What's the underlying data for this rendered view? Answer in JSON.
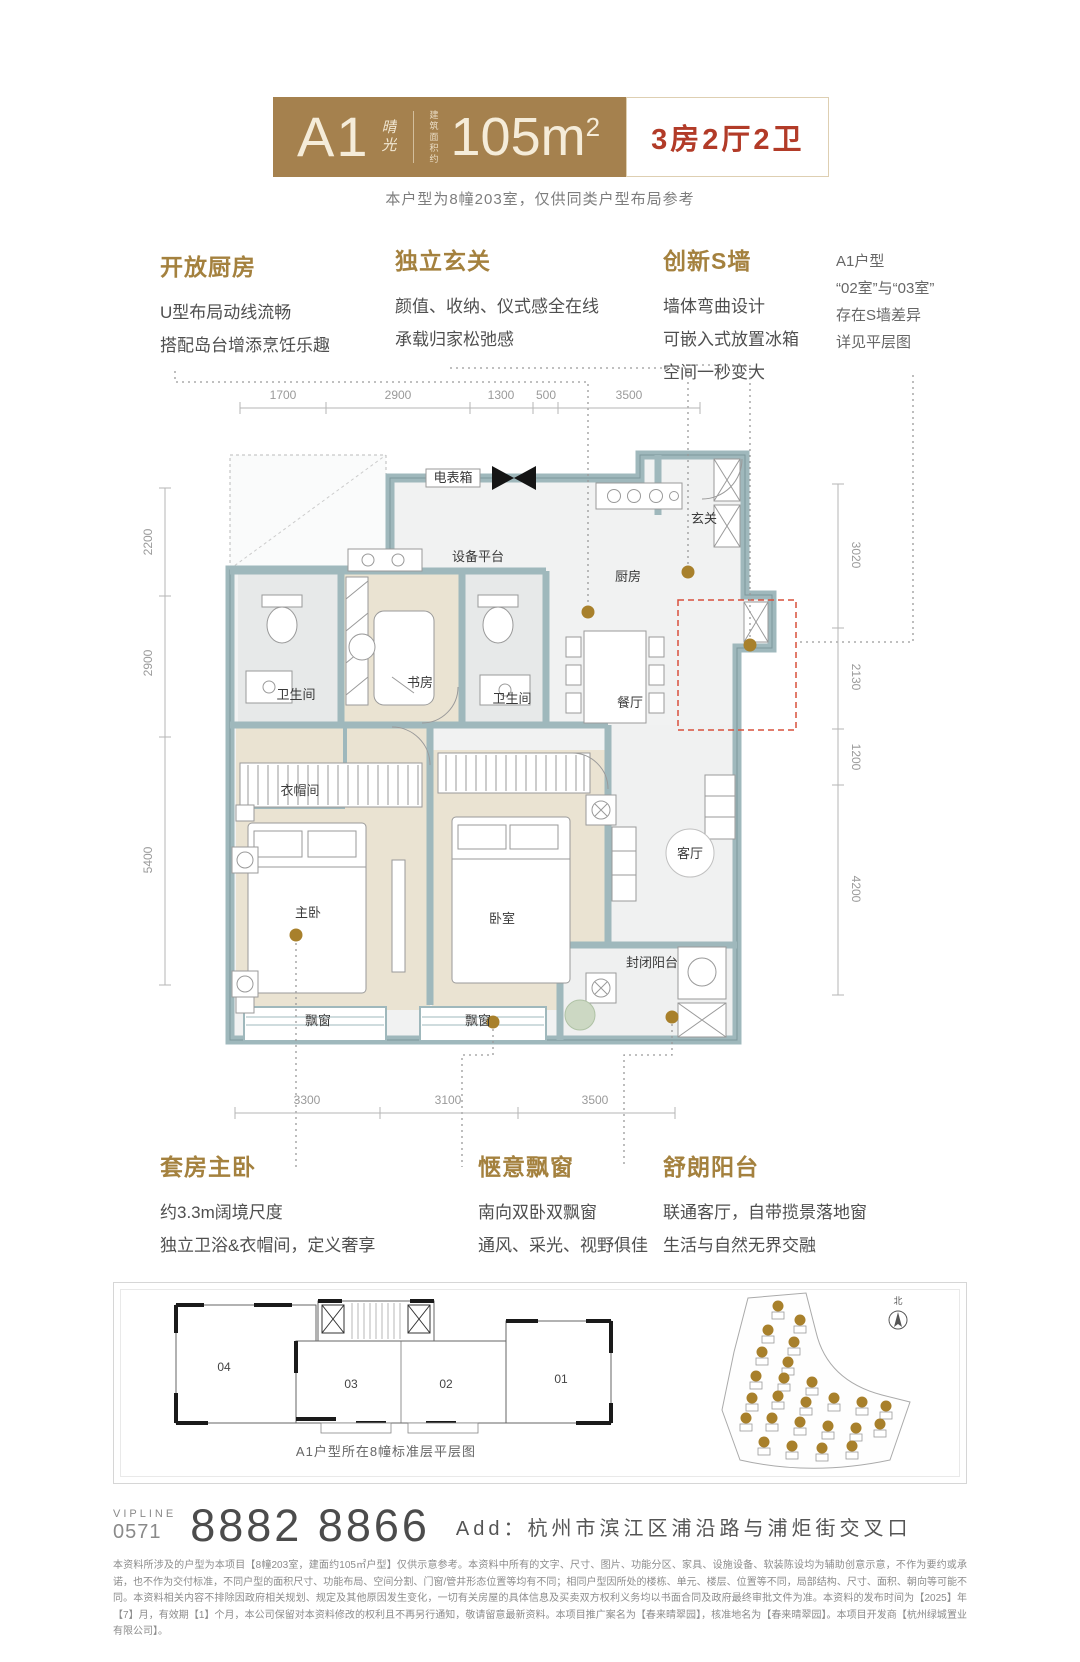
{
  "colors": {
    "brand_bronze": "#a5814e",
    "accent_red": "#b23b28",
    "heading_gold": "#a4813e",
    "wall": "#9fb8bc",
    "gold_dot": "#a8802b",
    "red_dash": "#d9503c"
  },
  "header": {
    "unit": "A1",
    "unit_script": "晴光",
    "area_prefix": "建筑面积约",
    "area": "105m",
    "area_sup": "2",
    "layout": "3房2厅2卫",
    "note": "本户型为8幢203室，仅供同类户型布局参考"
  },
  "features_top": [
    {
      "title": "开放厨房",
      "lines": [
        "U型布局动线流畅",
        "搭配岛台增添烹饪乐趣"
      ]
    },
    {
      "title": "独立玄关",
      "lines": [
        "颜值、收纳、仪式感全在线",
        "承载归家松弛感"
      ]
    },
    {
      "title": "创新S墙",
      "lines": [
        "墙体弯曲设计",
        "可嵌入式放置冰箱",
        "空间一秒变大"
      ]
    }
  ],
  "side_note": {
    "lines": [
      "A1户型",
      "“02室”与“03室”",
      "存在S墙差异",
      "详见平层图"
    ]
  },
  "features_bottom": [
    {
      "title": "套房主卧",
      "lines": [
        "约3.3m阔境尺度",
        "独立卫浴&衣帽间，定义奢享"
      ]
    },
    {
      "title": "惬意飘窗",
      "lines": [
        "南向双卧双飘窗",
        "通风、采光、视野俱佳"
      ]
    },
    {
      "title": "舒朗阳台",
      "lines": [
        "联通客厅，自带揽景落地窗",
        "生活与自然无界交融"
      ]
    }
  ],
  "floor_plan": {
    "room_labels": [
      {
        "label": "电表箱",
        "x": 453,
        "y": 127,
        "size": 8
      },
      {
        "label": "设备平台",
        "x": 478,
        "y": 206,
        "size": 13
      },
      {
        "label": "厨房",
        "x": 628,
        "y": 226,
        "size": 13
      },
      {
        "label": "玄关",
        "x": 704,
        "y": 168,
        "size": 13
      },
      {
        "label": "卫生间",
        "x": 296,
        "y": 344,
        "size": 12
      },
      {
        "label": "书房",
        "x": 420,
        "y": 332,
        "size": 14
      },
      {
        "label": "卫生间",
        "x": 512,
        "y": 348,
        "size": 12
      },
      {
        "label": "餐厅",
        "x": 630,
        "y": 352,
        "size": 12
      },
      {
        "label": "衣帽间",
        "x": 300,
        "y": 440,
        "size": 12
      },
      {
        "label": "主卧",
        "x": 308,
        "y": 562,
        "size": 14
      },
      {
        "label": "卧室",
        "x": 502,
        "y": 568,
        "size": 14
      },
      {
        "label": "客厅",
        "x": 690,
        "y": 503,
        "size": 12
      },
      {
        "label": "封闭阳台",
        "x": 652,
        "y": 612,
        "size": 12
      },
      {
        "label": "飘窗",
        "x": 318,
        "y": 670,
        "size": 11
      },
      {
        "label": "飘窗",
        "x": 478,
        "y": 670,
        "size": 11
      }
    ],
    "dim_labels": [
      {
        "value": "1700",
        "x": 283,
        "y": 44
      },
      {
        "value": "2900",
        "x": 398,
        "y": 44
      },
      {
        "value": "1300",
        "x": 501,
        "y": 44
      },
      {
        "value": "500",
        "x": 546,
        "y": 44
      },
      {
        "value": "3500",
        "x": 629,
        "y": 44
      },
      {
        "value": "2200",
        "x": 152,
        "y": 187,
        "rot": -90
      },
      {
        "value": "2900",
        "x": 152,
        "y": 308,
        "rot": -90
      },
      {
        "value": "5400",
        "x": 152,
        "y": 505,
        "rot": -90
      },
      {
        "value": "3020",
        "x": 852,
        "y": 200,
        "rot": 90
      },
      {
        "value": "2130",
        "x": 852,
        "y": 322,
        "rot": 90
      },
      {
        "value": "1200",
        "x": 852,
        "y": 402,
        "rot": 90
      },
      {
        "value": "4200",
        "x": 852,
        "y": 534,
        "rot": 90
      },
      {
        "value": "3300",
        "x": 307,
        "y": 749
      },
      {
        "value": "3100",
        "x": 448,
        "y": 749
      },
      {
        "value": "3500",
        "x": 595,
        "y": 749
      }
    ]
  },
  "building_plan": {
    "units": [
      {
        "label": "04",
        "x": 78,
        "y": 78
      },
      {
        "label": "03",
        "x": 205,
        "y": 95
      },
      {
        "label": "02",
        "x": 300,
        "y": 95
      },
      {
        "label": "01",
        "x": 415,
        "y": 90
      }
    ],
    "caption": "A1户型所在8幢标准层平层图"
  },
  "site_plan": {
    "north_label": "北",
    "markers": [
      [
        102,
        16
      ],
      [
        124,
        30
      ],
      [
        92,
        40
      ],
      [
        118,
        52
      ],
      [
        86,
        62
      ],
      [
        112,
        72
      ],
      [
        80,
        86
      ],
      [
        108,
        88
      ],
      [
        136,
        92
      ],
      [
        76,
        108
      ],
      [
        102,
        106
      ],
      [
        130,
        112
      ],
      [
        158,
        108
      ],
      [
        186,
        112
      ],
      [
        210,
        116
      ],
      [
        70,
        128
      ],
      [
        96,
        128
      ],
      [
        124,
        132
      ],
      [
        152,
        136
      ],
      [
        180,
        138
      ],
      [
        204,
        134
      ],
      [
        88,
        152
      ],
      [
        116,
        156
      ],
      [
        146,
        158
      ],
      [
        176,
        156
      ]
    ]
  },
  "contact": {
    "vipline_label": "VIPLINE",
    "area_code": "0571",
    "phone": "8882 8866",
    "address": "Add：杭州市滨江区浦沿路与浦炬街交叉口"
  },
  "fineprint": "本资料所涉及的户型为本项目【8幢203室，建面约105㎡户型】仅供示意参考。本资料中所有的文字、尺寸、图片、功能分区、家具、设施设备、软装陈设均为辅助创意示意，不作为要约或承诺，也不作为交付标准，不同户型的面积尺寸、功能布局、空间分割、门窗/管井形态位置等均有不同；相同户型因所处的楼栋、单元、楼层、位置等不同，局部结构、尺寸、面积、朝向等可能不同。本资料相关内容不排除因政府相关规划、规定及其他原因发生变化，一切有关房屋的具体信息及买卖双方权利义务均以书面合同及政府最终审批文件为准。本资料的发布时间为【2025】年【7】月，有效期【1】个月，本公司保留对本资料修改的权利且不再另行通知，敬请留意最新资料。本项目推广案名为【春来晴翠园】，核准地名为【春来晴翠园】。本项目开发商【杭州绿城置业有限公司】。"
}
